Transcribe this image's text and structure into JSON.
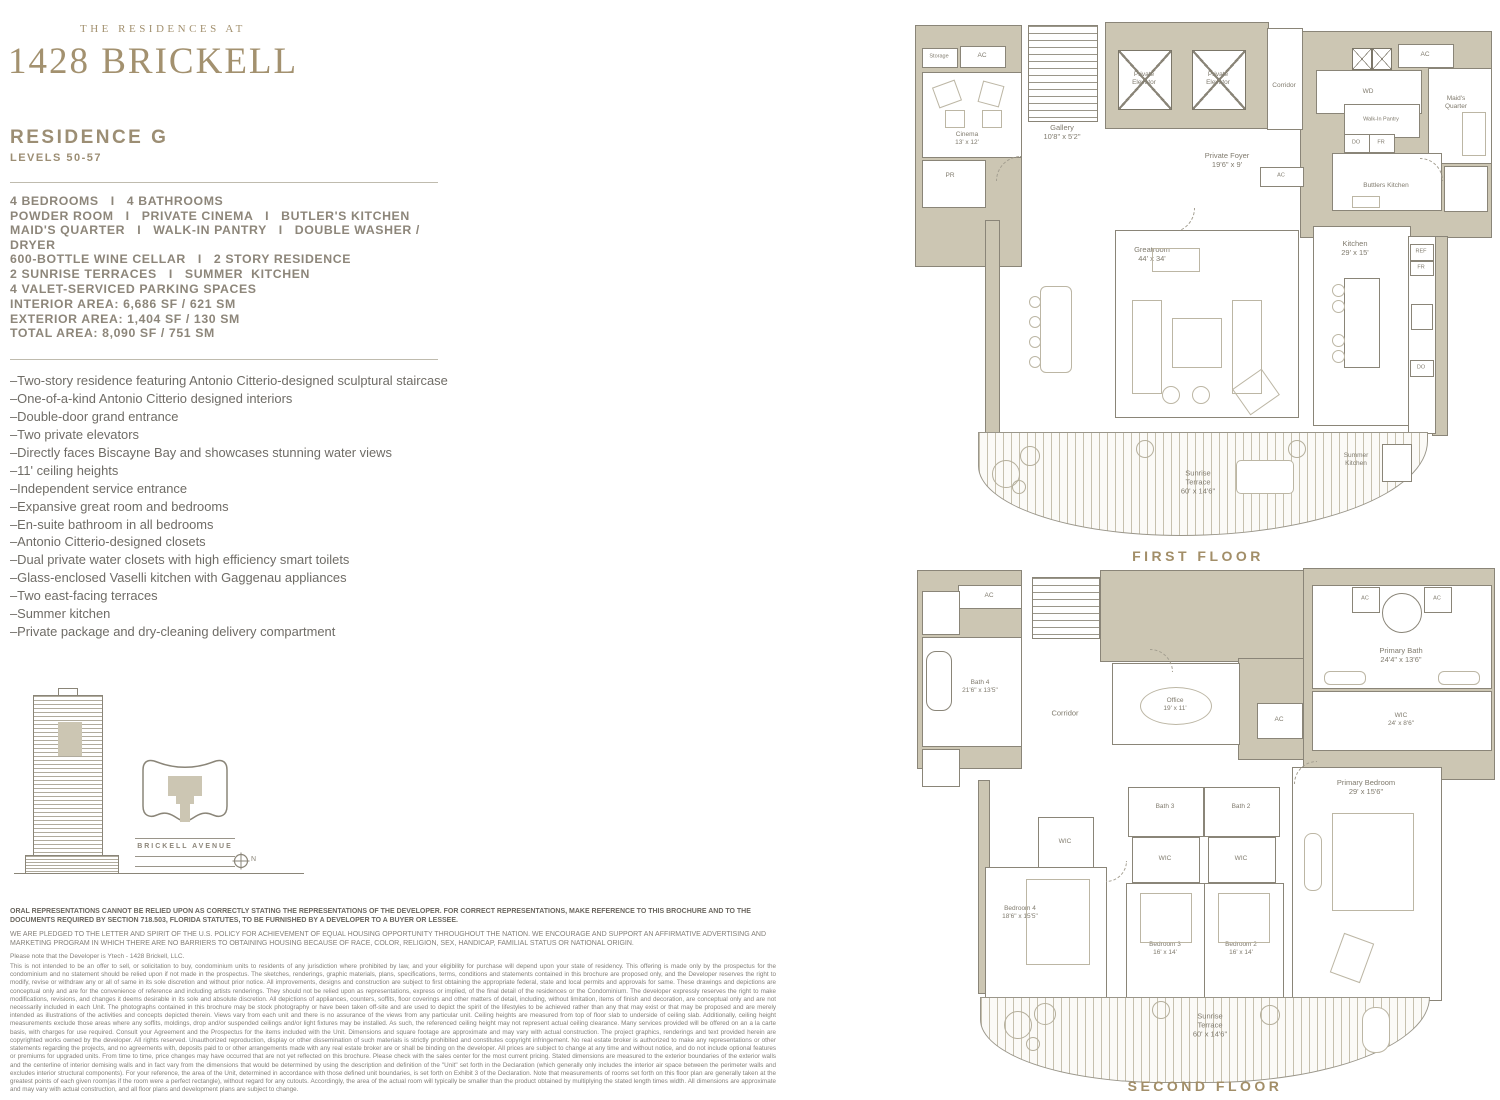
{
  "colors": {
    "brand": "#a3916f",
    "wall": "#ccc6b3",
    "text": "#7d796d"
  },
  "header": {
    "eyebrow": "THE RESIDENCES AT",
    "title": "1428 BRICKELL",
    "residence": "RESIDENCE G",
    "levels": "LEVELS 50-57"
  },
  "caps": [
    "4 BEDROOMS   I   4 BATHROOMS",
    "POWDER ROOM   I   PRIVATE CINEMA   I   BUTLER'S KITCHEN",
    "MAID'S QUARTER   I   WALK-IN PANTRY   I   DOUBLE WASHER / DRYER",
    "600-BOTTLE WINE CELLAR   I   2 STORY RESIDENCE",
    "2 SUNRISE TERRACES   I   SUMMER  KITCHEN",
    "4 VALET-SERVICED PARKING SPACES"
  ],
  "areas": [
    "INTERIOR AREA: 6,686 SF / 621 SM",
    "EXTERIOR AREA: 1,404 SF / 130 SM",
    "TOTAL AREA: 8,090 SF / 751 SM"
  ],
  "bullets": [
    "–Two-story residence featuring Antonio Citterio-designed sculptural staircase",
    "–One-of-a-kind Antonio Citterio designed interiors",
    "–Double-door grand entrance",
    "–Two private elevators",
    "–Directly faces Biscayne Bay and showcases stunning water views",
    "–11' ceiling heights",
    "–Independent service entrance",
    "–Expansive great room and bedrooms",
    "–En-suite bathroom in all bedrooms",
    "–Antonio Citterio-designed closets",
    "–Dual private water closets with high efficiency smart toilets",
    "–Glass-enclosed Vaselli kitchen with Gaggenau appliances",
    "–Two east-facing terraces",
    "–Summer kitchen",
    "–Private package and dry-cleaning delivery compartment"
  ],
  "keyplan": {
    "street": "BRICKELL AVENUE",
    "north": "N"
  },
  "disclaimer": {
    "p1": "ORAL REPRESENTATIONS CANNOT BE RELIED UPON AS CORRECTLY STATING THE REPRESENTATIONS OF THE DEVELOPER. FOR CORRECT REPRESENTATIONS, MAKE REFERENCE TO THIS BROCHURE AND TO THE DOCUMENTS REQUIRED BY SECTION 718.503, FLORIDA STATUTES, TO BE FURNISHED BY A DEVELOPER TO A BUYER OR LESSEE.",
    "p2": "WE ARE PLEDGED TO THE LETTER AND SPIRIT OF THE U.S. POLICY FOR ACHIEVEMENT OF EQUAL HOUSING OPPORTUNITY THROUGHOUT THE NATION. WE ENCOURAGE AND SUPPORT AN AFFIRMATIVE ADVERTISING AND MARKETING PROGRAM IN WHICH THERE ARE NO BARRIERS TO OBTAINING HOUSING BECAUSE OF RACE, COLOR, RELIGION, SEX, HANDICAP, FAMILIAL STATUS OR NATIONAL ORIGIN.",
    "p3": "Please note that the Developer is Ytech - 1428 Brickell, LLC.",
    "p4": "This is not intended to be an offer to sell, or solicitation to buy, condominium units to residents of any jurisdiction where prohibited by law, and your eligibility for purchase will depend upon your state of residency. This offering is made only by the prospectus for the condominium and no statement should be relied upon if not made in the prospectus. The sketches, renderings, graphic materials, plans, specifications, terms, conditions and statements contained in this brochure are proposed only, and the Developer reserves the right to modify, revise or withdraw any or all of same in its sole discretion and without prior notice. All improvements, designs and construction are subject to first obtaining the appropriate federal, state and local permits and approvals for same. These drawings and depictions are conceptual only and are for the convenience of reference and including artists renderings. They should not be relied upon as representations, express or implied, of the final detail of the residences or the Condominium. The developer expressly reserves the right to make modifications, revisions, and changes it deems desirable in its sole and absolute discretion. All depictions of appliances, counters, soffits, floor coverings and other matters of detail, including, without limitation, items of finish and decoration, are conceptual only and are not necessarily included in each Unit. The photographs contained in this brochure may be stock photography or have been taken off-site and are used to depict the spirit of the lifestyles to be achieved rather than any that may exist or that may be proposed and are merely intended as illustrations of the activities and concepts depicted therein. Views vary from each unit and there is no assurance of the views from any particular unit. Ceiling heights are measured from top of floor slab to underside of ceiling slab. Additionally, ceiling height measurements exclude those areas where any soffits, moldings, drop and/or suspended ceilings and/or light fixtures may be installed. As such, the referenced ceiling height may not represent actual ceiling clearance. Many services provided will be offered on an a la carte basis, with charges for use required. Consult your Agreement and the Prospectus for the items included with the Unit. Dimensions and square footage are approximate and may vary with actual construction. The project graphics, renderings and text provided herein are copyrighted works owned by the developer. All rights reserved. Unauthorized reproduction, display or other dissemination of such materials is strictly prohibited and constitutes copyright infringement. No real estate broker is authorized to make any representations or other statements regarding the projects, and no agreements with, deposits paid to or other arrangements made with any real estate broker are or shall be binding on the developer. All prices are subject to change at any time and without notice, and do not include optional features or premiums for upgraded units. From time to time, price changes may have occurred that are not yet reflected on this brochure. Please check with the sales center for the most current pricing. Stated dimensions are measured to the exterior boundaries of the exterior walls and the centerline of interior demising walls and in fact vary from the dimensions that would be determined by using the description and definition of the \"Unit\" set forth in the Declaration (which generally only includes the interior air space between the perimeter walls and excludes interior structural components). For your reference, the area of the Unit, determined in accordance with those defined unit boundaries, is set forth on Exhibit 3 of the Declaration. Note that measurements of rooms set forth on this floor plan are generally taken at the greatest points of each given room(as if the room were a perfect rectangle), without regard for any cutouts. Accordingly, the area of the actual room will typically be smaller than the product obtained by multiplying the stated length times width. All dimensions are approximate and may vary with actual construction, and all floor plans and development plans are subject to change."
  },
  "floor1": {
    "caption": "FIRST FLOOR",
    "rooms": {
      "storage": "Storage",
      "ac1": "AC",
      "cinema": "Cinema\n13' x 12'",
      "pr": "PR",
      "gallery": "Gallery\n10'8\" x 5'2\"",
      "elevator1": "Private\nElevator",
      "elevator2": "Private\nElevator",
      "corridor": "Corridor",
      "wd": "WD",
      "ac2": "AC",
      "maids": "Maid's\nQuarter",
      "pantry": "Walk-In Pantry",
      "do1": "DO",
      "fr1": "FR",
      "butlers": "Buttlers Kitchen",
      "foyer": "Private Foyer\n19'6\" x 9'",
      "ac3": "AC",
      "greatroom": "Greatroom\n44' x 34'",
      "kitchen": "Kitchen\n29' x 15'",
      "ref": "REF",
      "fr2": "FR",
      "do2": "DO",
      "terrace": "Sunrise\nTerrace\n60' x 14'6\"",
      "summer": "Summer\nKitchen"
    }
  },
  "floor2": {
    "caption": "SECOND FLOOR",
    "rooms": {
      "ac1": "AC",
      "bath4": "Bath 4\n21'6\" x 13'5\"",
      "corridor": "Corridor",
      "office": "Office\n19' x 11'",
      "ac2": "AC",
      "primary_bath": "Primary Bath\n24'4\" x 13'6\"",
      "ac3": "AC",
      "ac4": "AC",
      "wic_primary": "WIC\n24' x 8'6\"",
      "primary_bedroom": "Primary Bedroom\n29' x 15'6\"",
      "wic4": "WIC",
      "bath3": "Bath 3",
      "bath2": "Bath 2",
      "wic2": "WIC",
      "wic3": "WIC",
      "bedroom4": "Bedroom 4\n18'6\" x 15'5\"",
      "bedroom3": "Bedroom 3\n16' x 14'",
      "bedroom2": "Bedroom 2\n16' x 14'",
      "terrace": "Sunrise\nTerrace\n60' x 14'6\""
    }
  }
}
